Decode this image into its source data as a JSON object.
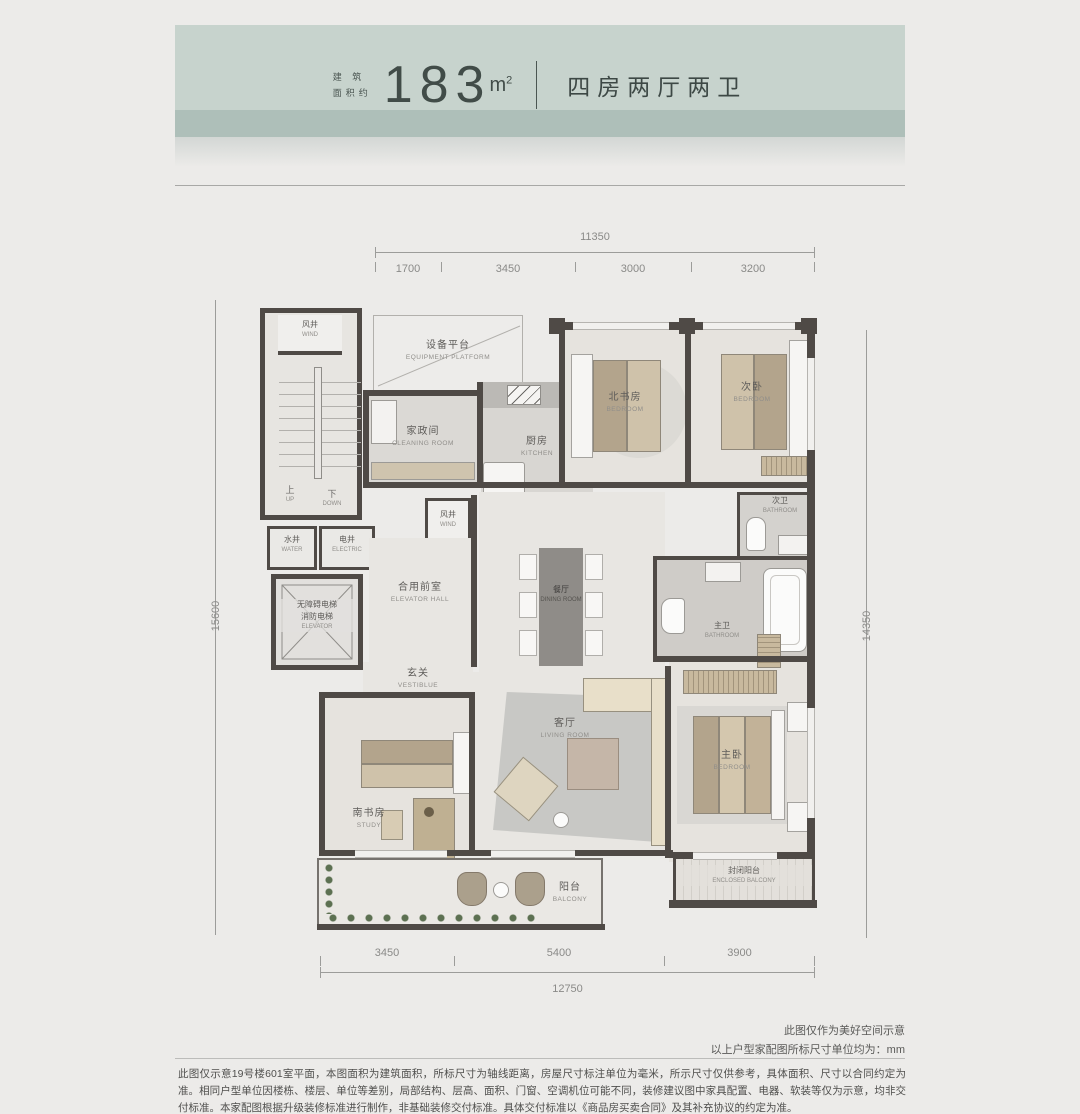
{
  "header": {
    "area_prefix_l1": "建 筑",
    "area_prefix_l2": "面积约",
    "area_value": "183",
    "area_unit": "m",
    "area_unit_sup": "2",
    "layout_type": "四房两厅两卫"
  },
  "dimensions": {
    "top": {
      "total": "11350",
      "segments": [
        "1700",
        "3450",
        "3000",
        "3200"
      ]
    },
    "bottom": {
      "total": "12750",
      "segments": [
        "3450",
        "5400",
        "3900"
      ]
    },
    "left_total": "15600",
    "right_total": "14350"
  },
  "stairs": {
    "up_cn": "上",
    "up_en": "UP",
    "down_cn": "下",
    "down_en": "DOWN"
  },
  "rooms": {
    "wind_top": {
      "cn": "风井",
      "en": "WIND"
    },
    "equipment_platform": {
      "cn": "设备平台",
      "en": "EQUIPMENT PLATFORM"
    },
    "cleaning_room": {
      "cn": "家政间",
      "en": "CLEANING ROOM"
    },
    "kitchen": {
      "cn": "厨房",
      "en": "KITCHEN"
    },
    "north_study": {
      "cn": "北书房",
      "en": "BEDROOM"
    },
    "second_bedroom": {
      "cn": "次卧",
      "en": "BEDROOM"
    },
    "wind_mid": {
      "cn": "风井",
      "en": "WIND"
    },
    "second_bath": {
      "cn": "次卫",
      "en": "BATHROOM"
    },
    "water_shaft": {
      "cn": "水井",
      "en": "WATER"
    },
    "electric_shaft": {
      "cn": "电井",
      "en": "ELECTRIC"
    },
    "elevator": {
      "cn1": "无障碍电梯",
      "cn2": "消防电梯",
      "en": "ELEVATOR"
    },
    "elevator_hall": {
      "cn": "合用前室",
      "en": "ELEVATOR HALL"
    },
    "dining": {
      "cn": "餐厅",
      "en": "DINING ROOM"
    },
    "master_bath": {
      "cn": "主卫",
      "en": "BATHROOM"
    },
    "vestibule": {
      "cn": "玄关",
      "en": "VESTIBLUE"
    },
    "living": {
      "cn": "客厅",
      "en": "LIVING ROOM"
    },
    "south_study": {
      "cn": "南书房",
      "en": "STUDY"
    },
    "master_bedroom": {
      "cn": "主卧",
      "en": "BEDROOM"
    },
    "balcony": {
      "cn": "阳台",
      "en": "BALCONY"
    },
    "enclosed_balcony": {
      "cn": "封闭阳台",
      "en": "ENCLOSED BALCONY"
    }
  },
  "notes": {
    "note1": "此图仅作为美好空间示意",
    "note2": "以上户型家配图所标尺寸单位均为：mm"
  },
  "disclaimer": "此图仅示意19号楼601室平面，本图面积为建筑面积，所标尺寸为轴线距离，房屋尺寸标注单位为毫米，所示尺寸仅供参考，具体面积、尺寸以合同约定为准。相同户型单位因楼栋、楼层、单位等差别，局部结构、层高、面积、门窗、空调机位可能不同，装修建议图中家具配置、电器、软装等仅为示意，均非交付标准。本家配图根据升级装修标准进行制作，非基础装修交付标准。具体交付标准以《商品房买卖合同》及其补充协议的约定为准。",
  "colors": {
    "banner": "#c7d3cd",
    "banner_band": "#aebfb9",
    "wall": "#4f4a46",
    "accent_text": "#3d4845"
  }
}
